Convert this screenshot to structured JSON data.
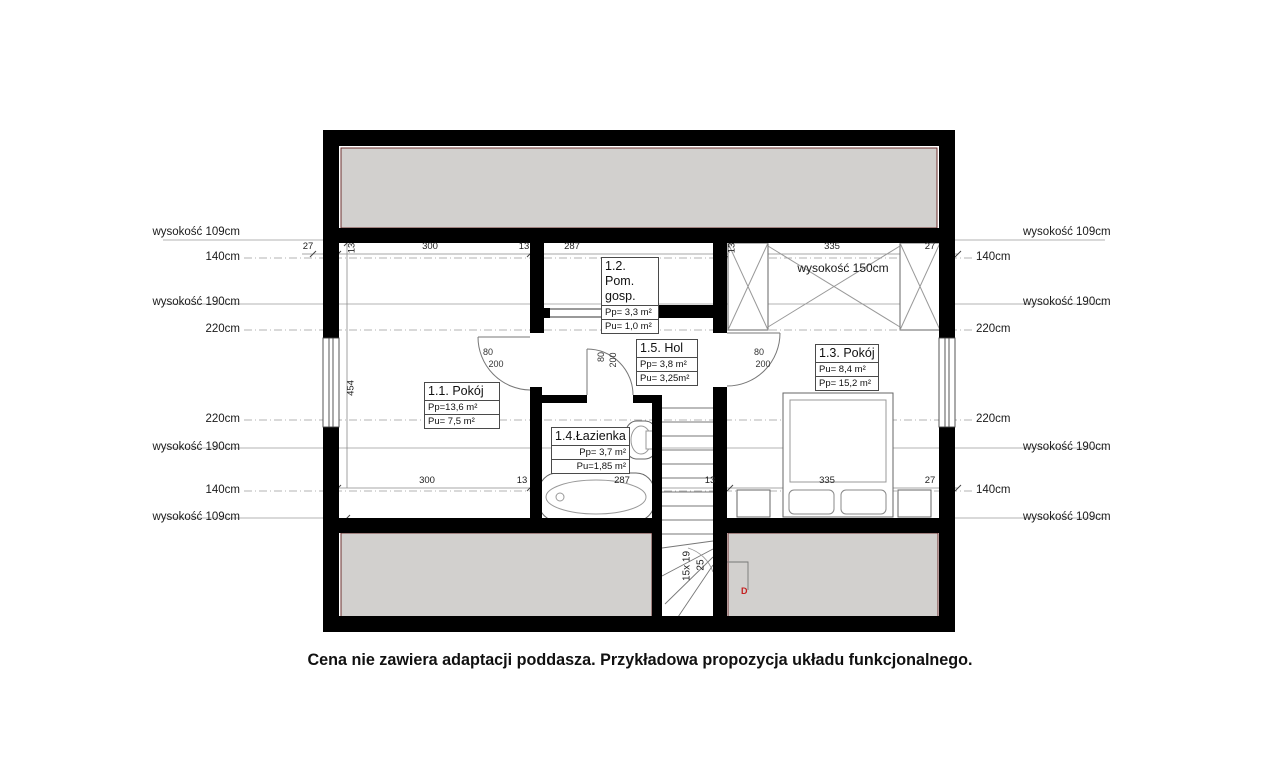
{
  "caption": "Cena nie zawiera adaptacji poddasza. Przykładowa propozycja układu funkcjonalnego.",
  "rooms": [
    {
      "name": "1.1. Pokój",
      "area1": "Pp=13,6 m²",
      "area2": "Pu=  7,5 m²"
    },
    {
      "name": "1.2. Pom. gosp.",
      "area1": "Pp= 3,3 m²",
      "area2": "Pu= 1,0 m²"
    },
    {
      "name": "1.3. Pokój",
      "area1": "Pu=  8,4 m²",
      "area2": "Pp=  15,2 m²"
    },
    {
      "name": "1.4.Łazienka",
      "area1": "Pp= 3,7 m²",
      "area2": "Pu=1,85 m²"
    },
    {
      "name": "1.5. Hol",
      "area1": "Pp= 3,8 m²",
      "area2": "Pu= 3,25m²"
    }
  ],
  "heights": {
    "h109": "wysokość 109cm",
    "h140": "140cm",
    "h190": "wysokość 190cm",
    "h220": "220cm",
    "attic": "wysokość 150cm"
  },
  "dims": {
    "top": [
      "27",
      "13",
      "300",
      "13",
      "287",
      "13",
      "335",
      "27"
    ],
    "bottom": [
      "300",
      "13",
      "287",
      "13",
      "335",
      "27"
    ],
    "side": "454",
    "door_w": "80",
    "door_h": "200"
  },
  "stairs": {
    "steps": "15x 19",
    "riser": "25",
    "marker": "D"
  },
  "colors": {
    "wall": "#000000",
    "roof_band_fill": "#d2d0ce",
    "roof_band_edge": "#6e2f2f",
    "marker_red": "#c42020"
  }
}
